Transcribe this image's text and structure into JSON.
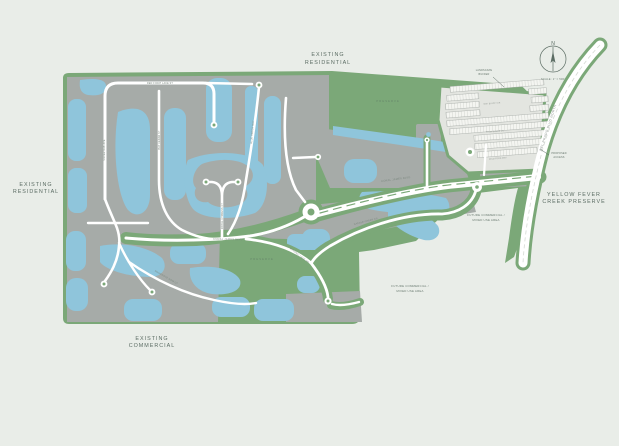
{
  "title": "Master Plan Site Map",
  "colors": {
    "bg": "#E9EDE8",
    "green": "#7BA878",
    "gray": "#A6ABA8",
    "water": "#8FC5DB",
    "road": "#FFFFFF",
    "ink": "#5B6C63"
  },
  "surroundings": {
    "existing_residential_top": {
      "line1": "EXISTING",
      "line2": "RESIDENTIAL"
    },
    "existing_residential_left": {
      "line1": "EXISTING",
      "line2": "RESIDENTIAL"
    },
    "existing_commercial": {
      "line1": "EXISTING",
      "line2": "COMMERCIAL"
    },
    "yellow_fever_creek": {
      "line1": "YELLOW FEVER",
      "line2": "CREEK PRESERVE"
    },
    "future_commercial_east": {
      "line1": "FUTURE COMMERCIAL /",
      "line2": "MIXED USE AREA"
    },
    "future_commercial_south": {
      "line1": "FUTURE COMMERCIAL /",
      "line2": "MIXED USE AREA"
    }
  },
  "areas": {
    "preserve_north": "PRESERVE",
    "preserve_south": "PRESERVE"
  },
  "compass": {
    "north_label": "N",
    "scale_label": "SCALE: 1\" = 500'"
  },
  "roads": {
    "del_prado": "DEL PRADO BLVD NORTH",
    "main_blvd": "CORAL JAMES BLVD",
    "main_blvd_south": "CORAL JAMES BLVD",
    "red_finch": "RED FINCH LAKE ST",
    "silver_oak": "SILVER OAK AVE",
    "bay_cedar": "BAY CEDAR ST",
    "blue_heron": "BLUE HERON WAY",
    "royal_cypress": "ROYAL CYPRESS CT",
    "saddle_creek": "SADDLE CREEK DR",
    "mangrove_row": "MANGROVE ROW CT",
    "winding_lake": "WINDING LAKE DR",
    "oak_bluff": "OAK BLUFF CIR",
    "palm_shade": "PALM SHADE LN",
    "wild_fern": "WILD FERN WAY"
  },
  "callouts": {
    "landscape_buffer": {
      "line1": "LANDSCAPE",
      "line2": "BUFFER"
    },
    "proposed_access": {
      "line1": "PROPOSED",
      "line2": "ACCESS"
    }
  }
}
